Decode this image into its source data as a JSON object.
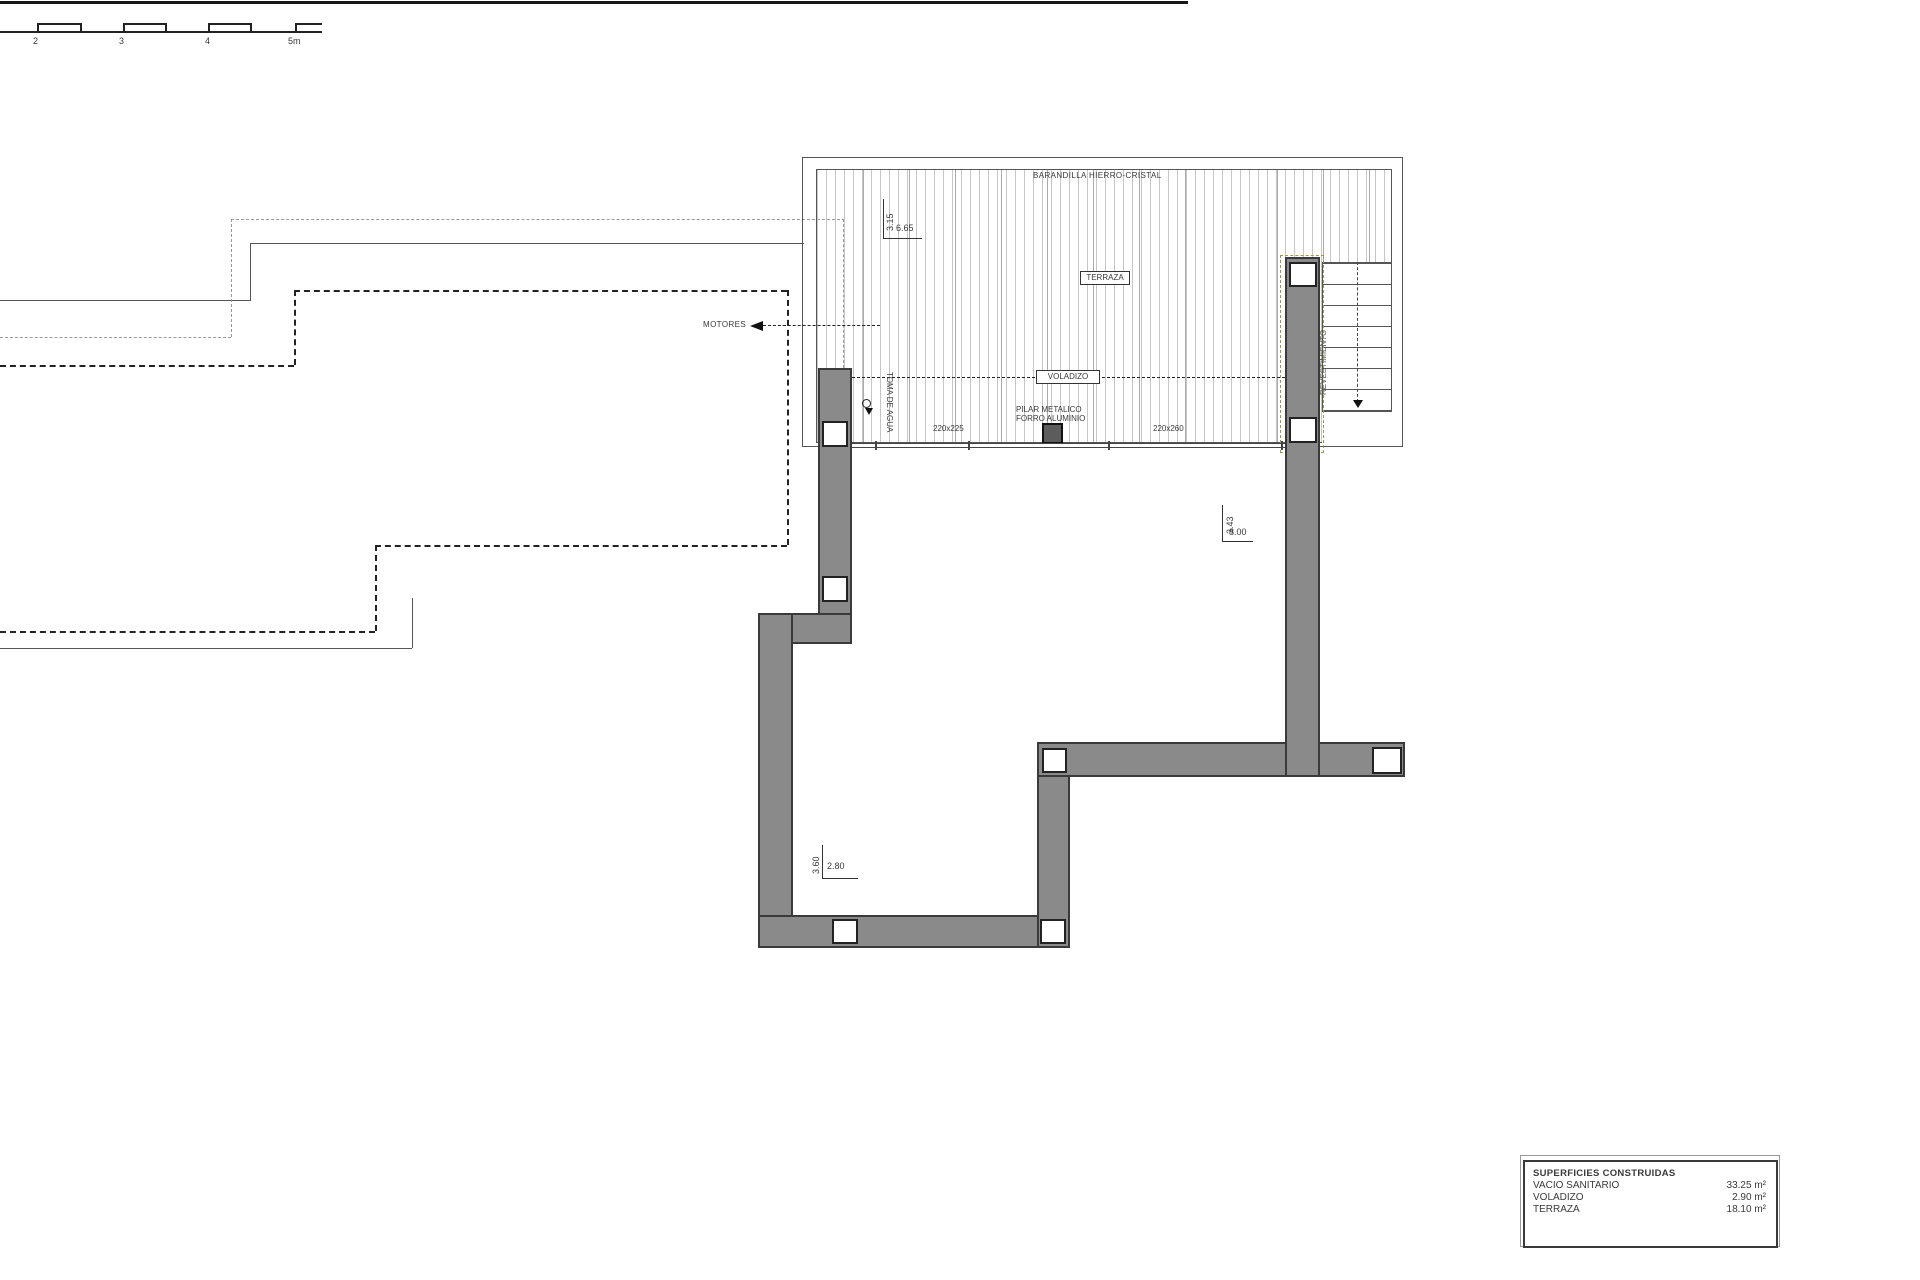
{
  "scale_bar": {
    "labels": [
      "2",
      "3",
      "4",
      "5m"
    ]
  },
  "plan": {
    "barandilla": "BARANDILLA HIERRO-CRISTAL",
    "terraza": "TERRAZA",
    "voladizo": "VOLADIZO",
    "motores": "MOTORES",
    "toma_de_agua": "TOMA DE AGUA",
    "pilar_l1": "PILAR METALICO",
    "pilar_l2": "FORRO ALUMINIO",
    "revestimiento": "REVESTIMIENTO",
    "dim_220x225": "220x225",
    "dim_220x260": "220x260",
    "dims": {
      "terrace_v": "3.15",
      "terrace_h": "6.65",
      "upper_v": "3.43",
      "upper_h": "8.00",
      "lower_v": "3.60",
      "lower_h": "2.80"
    }
  },
  "legend": {
    "title": "SUPERFICIES CONSTRUIDAS",
    "rows": [
      {
        "name": "VACIO SANITARIO",
        "value": "33.25 m²"
      },
      {
        "name": "VOLADIZO",
        "value": "2.90 m²"
      },
      {
        "name": "TERRAZA",
        "value": "18.10 m²"
      }
    ]
  },
  "colors": {
    "wall": "#8a8a8a",
    "outline": "#3a3a3a",
    "hatch": "#c6c6c6",
    "olive": "#9a9a50"
  }
}
